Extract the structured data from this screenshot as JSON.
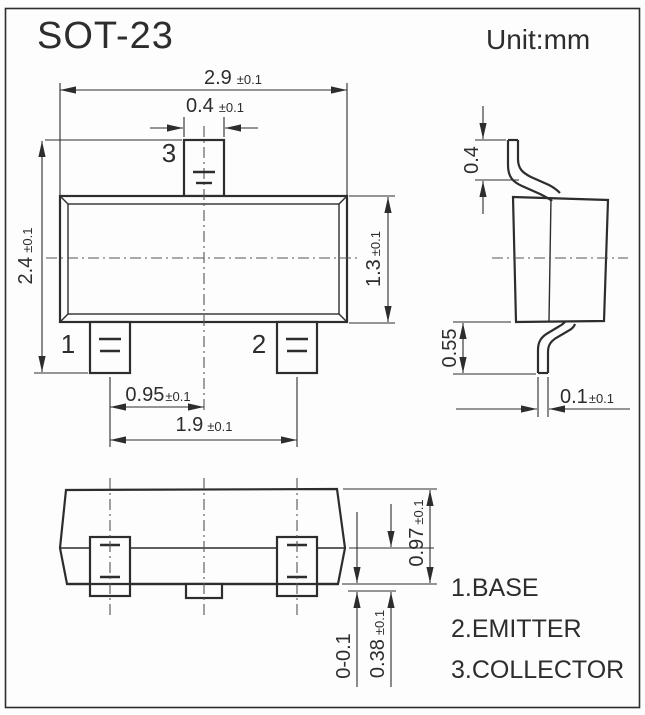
{
  "page": {
    "title": "SOT-23",
    "unit": "Unit:mm"
  },
  "legend": {
    "items": [
      {
        "label": "1.BASE"
      },
      {
        "label": "2.EMITTER"
      },
      {
        "label": "3.COLLECTOR"
      }
    ]
  },
  "pins": {
    "p1": "1",
    "p2": "2",
    "p3": "3"
  },
  "dims": {
    "body_width": {
      "v": "2.9",
      "t": "±0.1"
    },
    "pin3_width": {
      "v": "0.4",
      "t": "±0.1"
    },
    "overall_height": {
      "v": "2.4",
      "t": "±0.1"
    },
    "body_height": {
      "v": "1.3",
      "t": "±0.1"
    },
    "pin_offset": {
      "v": "0.95",
      "t": "±0.1"
    },
    "pin_pitch": {
      "v": "1.9",
      "t": "±0.1"
    },
    "lead_top": {
      "v": "0.4"
    },
    "lead_bottom": {
      "v": "0.55"
    },
    "lead_thickness": {
      "v": "0.1",
      "t": "±0.1"
    },
    "pkg_height": {
      "v": "0.97",
      "t": "±0.1"
    },
    "standoff": {
      "v": "0-0.1"
    },
    "foot": {
      "v": "0.38",
      "t": "±0.1"
    }
  },
  "colors": {
    "line": "#2d2d2d",
    "background": "#fdfdfd"
  }
}
